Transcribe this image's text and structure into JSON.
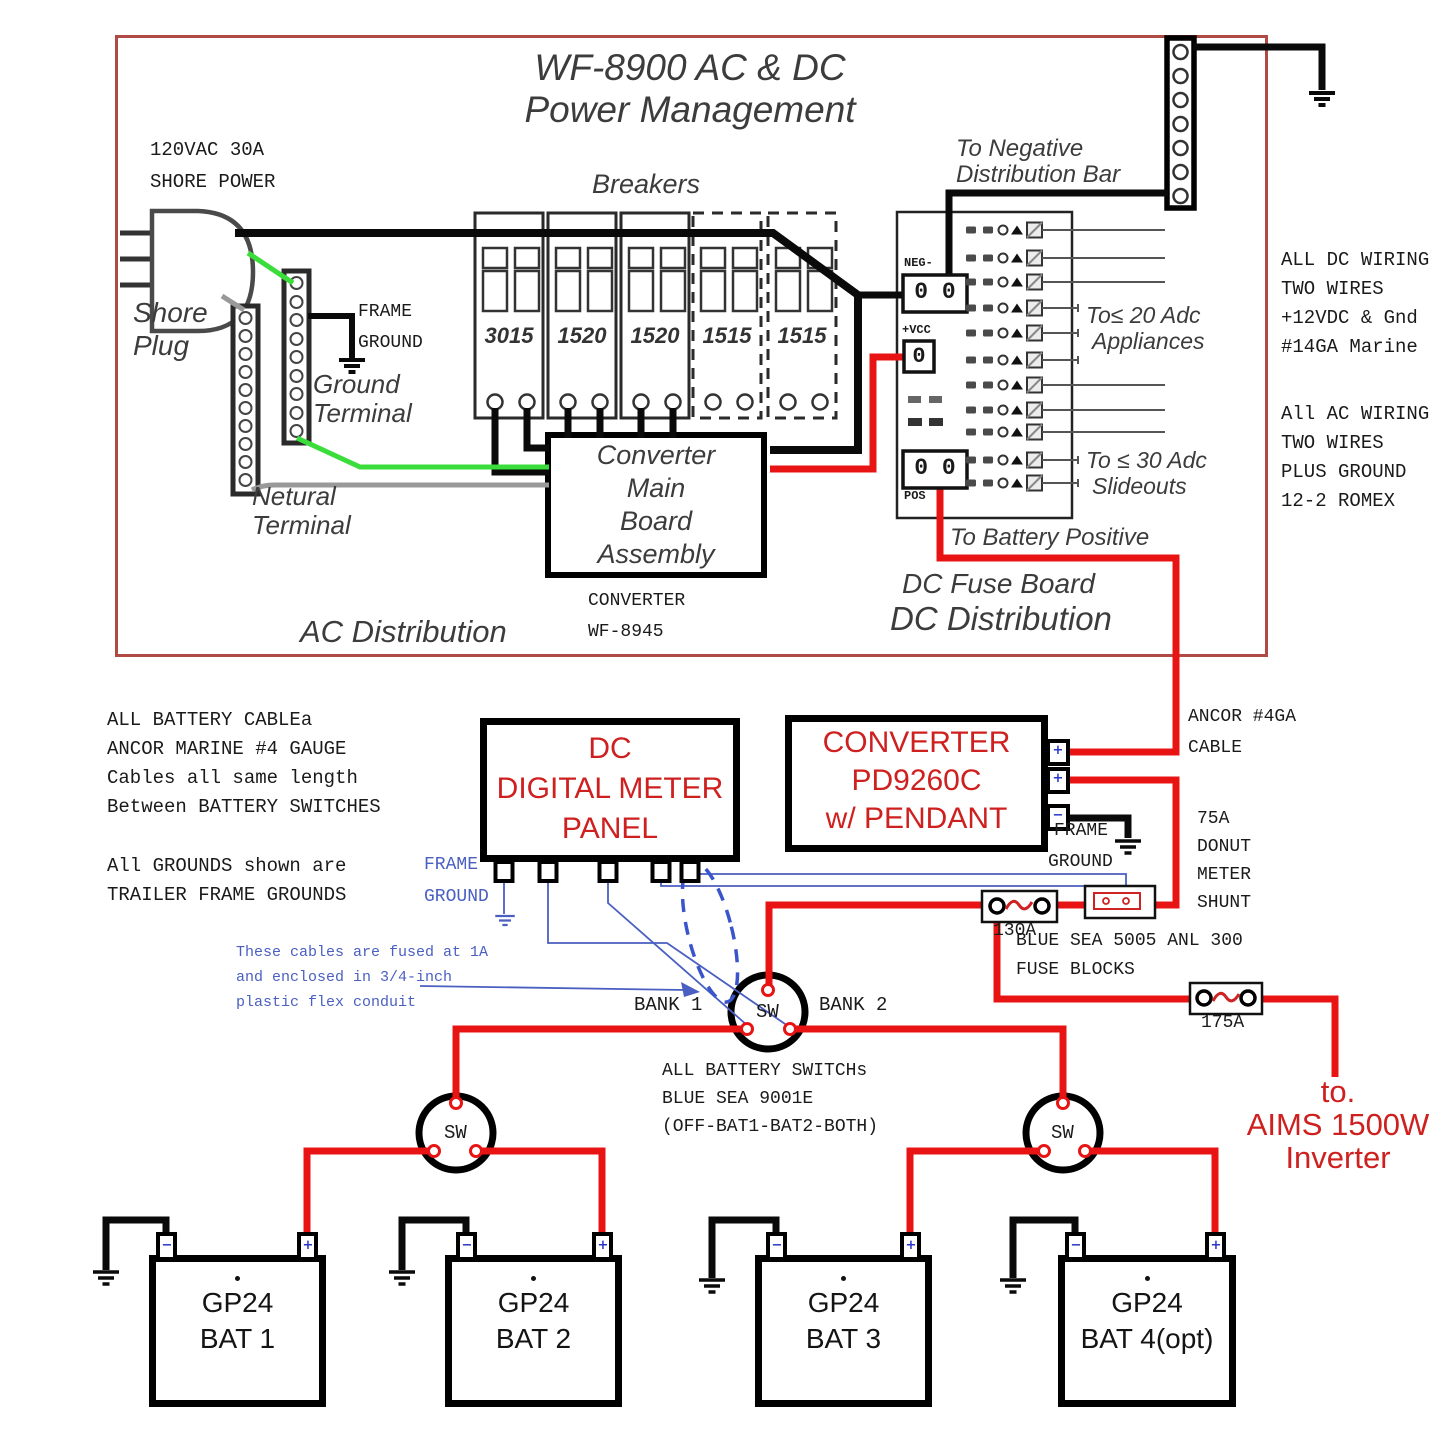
{
  "colors": {
    "wire_red": "#e81414",
    "wire_green": "#3bdd3b",
    "wire_gray": "#999999",
    "wire_blue": "#4a5fc1",
    "text_red": "#cf2020",
    "panel_border_red": "#b04a45"
  },
  "panel": {
    "title1": "WF-8900 AC & DC",
    "title2": "Power Management",
    "shore1": "120VAC 30A",
    "shore2": "SHORE POWER",
    "shore_plug1": "Shore",
    "shore_plug2": "Plug",
    "frame1": "FRAME",
    "ground1": "GROUND",
    "ground_term1": "Ground",
    "ground_term2": "Terminal",
    "neutral1": "Netural",
    "neutral2": "Terminal",
    "breakers_title": "Breakers",
    "breaker_labels": [
      "3015",
      "1520",
      "1520",
      "1515",
      "1515"
    ],
    "conv1": "Converter",
    "conv2": "Main",
    "conv3": "Board",
    "conv4": "Assembly",
    "conv_note1": "CONVERTER",
    "conv_note2": "WF-8945",
    "ac_dist": "AC Distribution",
    "to_neg1": "To Negative",
    "to_neg2": "Distribution Bar",
    "neg": "NEG-",
    "neg_t": "0 0",
    "vcc": "+VCC",
    "vcc_t": "0",
    "pos": "POS",
    "pos_t": "0 0",
    "appl1": "To≤ 20 Adc",
    "appl2": "Appliances",
    "slide1": "To ≤ 30 Adc",
    "slide2": "Slideouts",
    "to_bat_pos": "To Battery Positive",
    "dc_fuse": "DC Fuse Board",
    "dc_dist": "DC Distribution"
  },
  "notes": {
    "dc_wiring": [
      "ALL DC WIRING",
      "TWO WIRES",
      "+12VDC & Gnd",
      "#14GA Marine"
    ],
    "ac_wiring": [
      "All AC WIRING",
      "TWO WIRES",
      "PLUS GROUND",
      "12-2 ROMEX"
    ],
    "battery_cables": [
      "ALL BATTERY CABLEa",
      "ANCOR MARINE #4 GAUGE",
      "Cables all same length",
      "Between BATTERY SWITCHES"
    ],
    "grounds": [
      "All GROUNDS shown are",
      "TRAILER FRAME GROUNDS"
    ],
    "fused": [
      "These cables are fused at 1A",
      "and enclosed in 3/4-inch",
      "plastic flex conduit"
    ],
    "switches": [
      "ALL BATTERY SWITCHs",
      "BLUE SEA 9001E",
      "(OFF-BAT1-BAT2-BOTH)"
    ],
    "fuse_blocks": [
      "BLUE SEA 5005 ANL 300",
      "FUSE BLOCKS"
    ]
  },
  "meter": {
    "l1": "DC",
    "l2": "DIGITAL METER",
    "l3": "PANEL",
    "fg1": "FRAME",
    "fg2": "GROUND"
  },
  "converter": {
    "l1": "CONVERTER",
    "l2": "PD9260C",
    "l3": "w/ PENDANT",
    "fg1": "FRAME",
    "fg2": "GROUND",
    "plus": "+",
    "minus": "−"
  },
  "labels": {
    "ancor1": "ANCOR #4GA",
    "ancor2": "CABLE",
    "shunt": [
      "75A",
      "DONUT",
      "METER",
      "SHUNT"
    ],
    "fuse130": "130A",
    "fuse175": "175A",
    "bank1": "BANK 1",
    "bank2": "BANK 2",
    "sw": "SW",
    "inv1": "to.",
    "inv2": "AIMS 1500W",
    "inv3": "Inverter"
  },
  "batteries": [
    {
      "model": "GP24",
      "name": "BAT 1"
    },
    {
      "model": "GP24",
      "name": "BAT 2"
    },
    {
      "model": "GP24",
      "name": "BAT 3"
    },
    {
      "model": "GP24",
      "name": "BAT 4(opt)"
    }
  ],
  "battery_terminals": {
    "plus": "+",
    "minus": "−"
  }
}
